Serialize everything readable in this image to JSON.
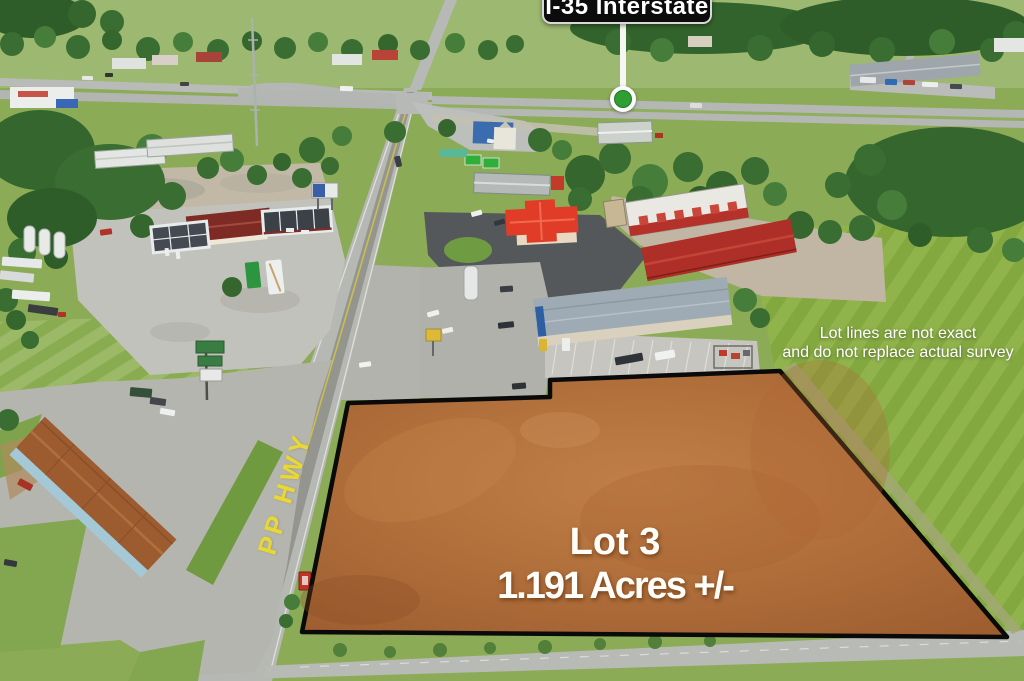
{
  "callout": {
    "label": "I-35 Interstate",
    "sign_color": "#0c0c0c",
    "pin_color": "#2f9e33"
  },
  "highway_label": {
    "text": "PP HWY",
    "color": "#e9d832"
  },
  "disclaimer": {
    "line1": "Lot lines are not exact",
    "line2": "and do not replace actual survey"
  },
  "lot": {
    "title": "Lot 3",
    "area": "1.191 Acres +/-",
    "fill": "#b2703c",
    "outline": "#000000"
  }
}
